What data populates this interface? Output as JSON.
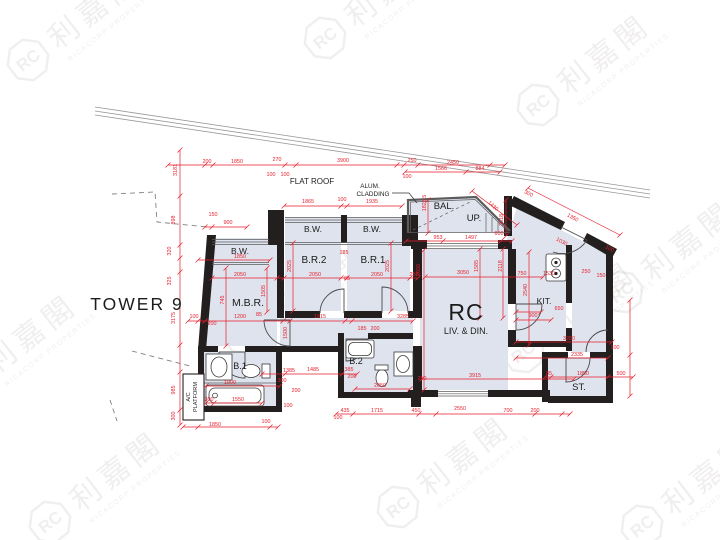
{
  "title": {
    "tower": "TOWER 9"
  },
  "labels": {
    "flat_roof": "FLAT ROOF",
    "alum_cladding_line1": "ALUM.",
    "alum_cladding_line2": "CLADDING",
    "ac_platform_line1": "A/C",
    "ac_platform_line2": "PLATFORM"
  },
  "rooms": {
    "rc": "RC",
    "liv_din": "LIV. & DIN.",
    "mbr": "M.B.R.",
    "br1": "B.R.1",
    "br2": "B.R.2",
    "bw1": "B.W.",
    "bw2": "B.W.",
    "bw3": "B.W.",
    "bal": "BAL.",
    "up": "UP.",
    "kit": "KIT.",
    "st": "ST.",
    "b1": "B.1",
    "b2": "B.2"
  },
  "watermark": {
    "logo": "RC",
    "cn": "利嘉閣",
    "en": "RICACORP PROPERTIES",
    "color": "#8a7a7a",
    "positions": [
      {
        "x": 28,
        "y": 60
      },
      {
        "x": 325,
        "y": 38
      },
      {
        "x": 538,
        "y": 105
      },
      {
        "x": -35,
        "y": 385
      },
      {
        "x": 243,
        "y": 333
      },
      {
        "x": 523,
        "y": 352
      },
      {
        "x": 50,
        "y": 522
      },
      {
        "x": 398,
        "y": 507
      },
      {
        "x": 642,
        "y": 526
      },
      {
        "x": 622,
        "y": 292
      }
    ]
  },
  "colors": {
    "dimension_red": "#e61e2b",
    "wall_black": "#241f1f",
    "room_fill": "#dfe3ed"
  },
  "dimensions": [
    {
      "v": "200",
      "x": 207,
      "y": 163
    },
    {
      "v": "1850",
      "x": 237,
      "y": 163
    },
    {
      "v": "270",
      "x": 277,
      "y": 161
    },
    {
      "v": "100",
      "x": 271,
      "y": 176
    },
    {
      "v": "100",
      "x": 285,
      "y": 176
    },
    {
      "v": "3900",
      "x": 343,
      "y": 162
    },
    {
      "v": "250",
      "x": 412,
      "y": 162
    },
    {
      "v": "2450",
      "x": 453,
      "y": 164
    },
    {
      "v": "1566",
      "x": 441,
      "y": 170
    },
    {
      "v": "884",
      "x": 480,
      "y": 170
    },
    {
      "v": "100",
      "x": 407,
      "y": 178
    },
    {
      "v": "3181",
      "x": 177,
      "y": 170,
      "r": -90
    },
    {
      "v": "898",
      "x": 175,
      "y": 220,
      "r": -90
    },
    {
      "v": "320",
      "x": 171,
      "y": 251,
      "r": -90
    },
    {
      "v": "325",
      "x": 171,
      "y": 281,
      "r": -90
    },
    {
      "v": "3175",
      "x": 175,
      "y": 318,
      "r": -90
    },
    {
      "v": "985",
      "x": 175,
      "y": 390,
      "r": -90
    },
    {
      "v": "300",
      "x": 175,
      "y": 416,
      "r": -90
    },
    {
      "v": "1865",
      "x": 308,
      "y": 203
    },
    {
      "v": "100",
      "x": 342,
      "y": 201
    },
    {
      "v": "1935",
      "x": 372,
      "y": 203
    },
    {
      "v": "150",
      "x": 213,
      "y": 216
    },
    {
      "v": "900",
      "x": 228,
      "y": 224
    },
    {
      "v": "1850",
      "x": 240,
      "y": 258
    },
    {
      "v": "185",
      "x": 344,
      "y": 254
    },
    {
      "v": "2050",
      "x": 240,
      "y": 276
    },
    {
      "v": "2050",
      "x": 315,
      "y": 276
    },
    {
      "v": "85",
      "x": 347,
      "y": 280
    },
    {
      "v": "2050",
      "x": 377,
      "y": 276
    },
    {
      "v": "250",
      "x": 414,
      "y": 276
    },
    {
      "v": "2025",
      "x": 291,
      "y": 266,
      "r": -90
    },
    {
      "v": "2025",
      "x": 389,
      "y": 266,
      "r": -90
    },
    {
      "v": "745",
      "x": 224,
      "y": 300,
      "r": -90
    },
    {
      "v": "1505",
      "x": 265,
      "y": 291,
      "r": -90
    },
    {
      "v": "1500",
      "x": 287,
      "y": 333,
      "r": -90
    },
    {
      "v": "100",
      "x": 194,
      "y": 318
    },
    {
      "v": "200",
      "x": 212,
      "y": 325
    },
    {
      "v": "1200",
      "x": 240,
      "y": 318
    },
    {
      "v": "85",
      "x": 259,
      "y": 316
    },
    {
      "v": "1915",
      "x": 320,
      "y": 318
    },
    {
      "v": "3285",
      "x": 403,
      "y": 318
    },
    {
      "v": "185",
      "x": 362,
      "y": 330
    },
    {
      "v": "200",
      "x": 375,
      "y": 330
    },
    {
      "v": "1823.5",
      "x": 426,
      "y": 203,
      "r": -90
    },
    {
      "v": "1430",
      "x": 492,
      "y": 207,
      "r": 43
    },
    {
      "v": "3618",
      "x": 503,
      "y": 220,
      "r": -90
    },
    {
      "v": "953",
      "x": 438,
      "y": 239
    },
    {
      "v": "1497",
      "x": 471,
      "y": 239
    },
    {
      "v": "600",
      "x": 499,
      "y": 235
    },
    {
      "v": "300",
      "x": 528,
      "y": 195,
      "r": 28
    },
    {
      "v": "1350",
      "x": 572,
      "y": 219,
      "r": 28
    },
    {
      "v": "1030",
      "x": 561,
      "y": 243,
      "r": 28
    },
    {
      "v": "100",
      "x": 609,
      "y": 250,
      "r": 28
    },
    {
      "v": "3050",
      "x": 463,
      "y": 274
    },
    {
      "v": "2650",
      "x": 420,
      "y": 270,
      "r": -90
    },
    {
      "v": "1585",
      "x": 478,
      "y": 266,
      "r": -90
    },
    {
      "v": "2118",
      "x": 502,
      "y": 266,
      "r": -90
    },
    {
      "v": "2540",
      "x": 527,
      "y": 290,
      "r": -90
    },
    {
      "v": "750",
      "x": 522,
      "y": 275
    },
    {
      "v": "1530",
      "x": 549,
      "y": 275
    },
    {
      "v": "250",
      "x": 586,
      "y": 273
    },
    {
      "v": "150",
      "x": 601,
      "y": 277
    },
    {
      "v": "650",
      "x": 559,
      "y": 310
    },
    {
      "v": "900",
      "x": 533,
      "y": 317
    },
    {
      "v": "3280",
      "x": 569,
      "y": 340
    },
    {
      "v": "2335",
      "x": 577,
      "y": 356
    },
    {
      "v": "100",
      "x": 615,
      "y": 349
    },
    {
      "v": "85",
      "x": 549,
      "y": 375
    },
    {
      "v": "1850",
      "x": 583,
      "y": 375
    },
    {
      "v": "500",
      "x": 621,
      "y": 375
    },
    {
      "v": "1385",
      "x": 289,
      "y": 372
    },
    {
      "v": "1485",
      "x": 313,
      "y": 371
    },
    {
      "v": "385",
      "x": 349,
      "y": 371
    },
    {
      "v": "300",
      "x": 282,
      "y": 382
    },
    {
      "v": "200",
      "x": 296,
      "y": 392
    },
    {
      "v": "100",
      "x": 288,
      "y": 407
    },
    {
      "v": "1800",
      "x": 230,
      "y": 384
    },
    {
      "v": "1550",
      "x": 238,
      "y": 401
    },
    {
      "v": "300",
      "x": 209,
      "y": 401
    },
    {
      "v": "1850",
      "x": 215,
      "y": 426
    },
    {
      "v": "100",
      "x": 266,
      "y": 423
    },
    {
      "v": "200",
      "x": 352,
      "y": 378
    },
    {
      "v": "2050",
      "x": 380,
      "y": 387
    },
    {
      "v": "250",
      "x": 422,
      "y": 380
    },
    {
      "v": "3915",
      "x": 475,
      "y": 377
    },
    {
      "v": "435",
      "x": 345,
      "y": 412
    },
    {
      "v": "100",
      "x": 338,
      "y": 419
    },
    {
      "v": "1715",
      "x": 377,
      "y": 412
    },
    {
      "v": "450",
      "x": 416,
      "y": 412
    },
    {
      "v": "2550",
      "x": 460,
      "y": 410
    },
    {
      "v": "700",
      "x": 508,
      "y": 412
    },
    {
      "v": "200",
      "x": 535,
      "y": 412
    }
  ]
}
